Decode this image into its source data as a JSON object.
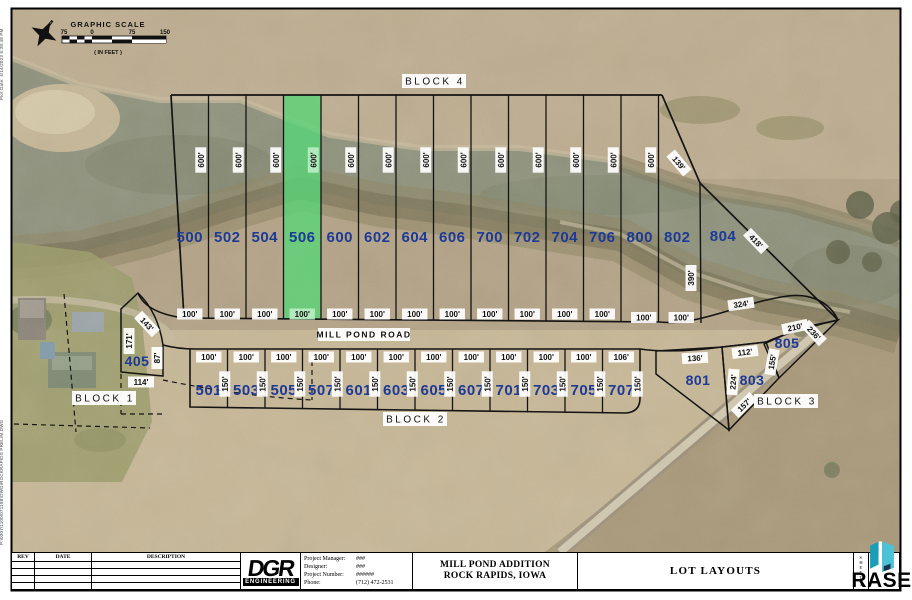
{
  "notes": {
    "plot_note": "Plot Date: 4/14/2023 5:38:48 PM",
    "path_note": "P:\\0307\\1100\\07110B\\DWG\\ROCKRAPIDS PRELIM.DWG"
  },
  "scale_bar": {
    "title": "GRAPHIC SCALE",
    "ticks": [
      "75",
      "0",
      "75",
      "150"
    ],
    "units_note": "( IN FEET )"
  },
  "road_name": "MILL POND ROAD",
  "block_labels": {
    "b1": "BLOCK 1",
    "b2": "BLOCK 2",
    "b3": "BLOCK 3",
    "b4": "BLOCK 4"
  },
  "colors": {
    "lot_number_blue": "#1c3a96",
    "highlight_green": "#57d677",
    "rase_teal": "#2fb4c9",
    "rase_navy": "#15294e"
  },
  "upper_lots": [
    {
      "id": "500",
      "depth": "600'",
      "width": "100'",
      "highlight": false
    },
    {
      "id": "502",
      "depth": "600'",
      "width": "100'",
      "highlight": false
    },
    {
      "id": "504",
      "depth": "600'",
      "width": "100'",
      "highlight": false
    },
    {
      "id": "506",
      "depth": "600'",
      "width": "100'",
      "highlight": true
    },
    {
      "id": "600",
      "depth": "600'",
      "width": "100'",
      "highlight": false
    },
    {
      "id": "602",
      "depth": "600'",
      "width": "100'",
      "highlight": false
    },
    {
      "id": "604",
      "depth": "600'",
      "width": "100'",
      "highlight": false
    },
    {
      "id": "606",
      "depth": "600'",
      "width": "100'",
      "highlight": false
    },
    {
      "id": "700",
      "depth": "600'",
      "width": "100'",
      "highlight": false
    },
    {
      "id": "702",
      "depth": "600'",
      "width": "100'",
      "highlight": false
    },
    {
      "id": "704",
      "depth": "600'",
      "width": "100'",
      "highlight": false
    },
    {
      "id": "706",
      "depth": "600'",
      "width": "100'",
      "highlight": false
    },
    {
      "id": "800",
      "depth": "600'",
      "width": "100'",
      "highlight": false
    },
    {
      "id": "802",
      "depth": null,
      "width": "100'",
      "highlight": false
    }
  ],
  "lot_804": {
    "id": "804",
    "dim_ne": "139'",
    "dim_se": "418'",
    "dim_w": "390'",
    "dim_s": "324'"
  },
  "lower_lots": [
    {
      "id": "501",
      "width": "100'",
      "depth": "150'"
    },
    {
      "id": "503",
      "width": "100'",
      "depth": "150'"
    },
    {
      "id": "505",
      "width": "100'",
      "depth": "150'"
    },
    {
      "id": "507",
      "width": "100'",
      "depth": "150'"
    },
    {
      "id": "601",
      "width": "100'",
      "depth": "150'"
    },
    {
      "id": "603",
      "width": "100'",
      "depth": "150'"
    },
    {
      "id": "605",
      "width": "100'",
      "depth": "150'"
    },
    {
      "id": "607",
      "width": "100'",
      "depth": "150'"
    },
    {
      "id": "701",
      "width": "100'",
      "depth": "150'"
    },
    {
      "id": "703",
      "width": "100'",
      "depth": "150'"
    },
    {
      "id": "705",
      "width": "100'",
      "depth": "150'"
    },
    {
      "id": "707",
      "width": "106'",
      "depth": "150'"
    }
  ],
  "lot_405": {
    "id": "405",
    "dim_nw": "143'",
    "dim_w": "171'",
    "dim_e": "87'",
    "dim_s": "114'"
  },
  "lot_801": {
    "id": "801",
    "dim_n": "136'"
  },
  "lot_803": {
    "id": "803",
    "dim_n": "112'",
    "dim_e": "224'",
    "dim_s": "157'"
  },
  "lot_805": {
    "id": "805",
    "dim_n": "210'",
    "dim_w": "155'",
    "dim_se": "236'"
  },
  "title_block": {
    "rev": "REV",
    "date": "DATE",
    "description": "DESCRIPTION",
    "logo_main": "DGR",
    "logo_sub": "ENGINEERING",
    "fields": [
      {
        "label": "Project Manager:",
        "value": "###"
      },
      {
        "label": "Designer:",
        "value": "###"
      },
      {
        "label": "Project Number:",
        "value": "######"
      },
      {
        "label": "Phone:",
        "value": "(712) 472-2531"
      }
    ],
    "project_title_line1": "MILL POND ADDITION",
    "project_title_line2": "ROCK RAPIDS, IOWA",
    "sheet_title": "LOT LAYOUTS",
    "sheet_word": "SHEET",
    "sheet_no": "1"
  },
  "watermark": {
    "brand": "RASE"
  }
}
